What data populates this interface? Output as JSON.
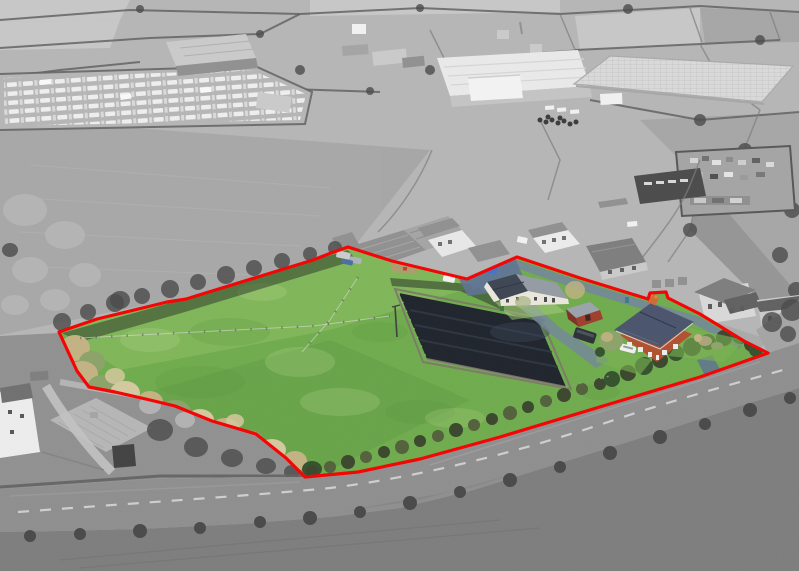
{
  "meta": {
    "title": "Aerial drone photograph of a smallholding for sale — plot outlined in red, property shown in colour against greyscale countryside",
    "width_px": 799,
    "height_px": 571,
    "style": "selective-colour aerial photograph"
  },
  "scene": {
    "highlighted_plot": [
      "large grass paddock with post-and-rail fencing",
      "mature winter trees along the south-west edge",
      "dark all-weather riding arena (menage)",
      "single-storey stable / annexe building with slate roof and white walls",
      "red timber shed with grey roof",
      "two-storey red-brick farmhouse with slate roof and chimney pots",
      "garden lawns, hedges and shrubs",
      "blue-grey tarmac driveways and parking",
      "white car, two blue cars, dark van, stored caravans",
      "telegraph pole in paddock"
    ],
    "greyscale_surroundings": [
      "patchwork farmland fields with hedgerows",
      "caravan storage yard full of white caravans",
      "large industrial warehouse unit",
      "glasshouse / polytunnel complex",
      "farm barns and concrete yards",
      "walled scrap and storage yard",
      "neighbouring houses and garages",
      "stone barn and white cottage beside the road",
      "country road with dashed centre line",
      "large field south of the road"
    ],
    "overlay": "continuous red boundary line enclosing the property"
  },
  "colors": {
    "boundary": "#f60000",
    "grass_light": "#93c468",
    "grass_mid": "#6fab4c",
    "grass_dark": "#55923a",
    "grass_pale": "#aacf7d",
    "hedge_dark": "#39462b",
    "hedge_mid": "#51603a",
    "bush_dark": "#33502c",
    "tree_tan": "#c3b382",
    "tree_tan_light": "#d4c89e",
    "tree_sage": "#8ba268",
    "arena": "#1d222b",
    "arena_streak": "#2f3844",
    "arena_edge": "#7b7567",
    "drive_blue": "#73849c",
    "drive_blue_dark": "#5d7292",
    "brick": "#b1502e",
    "brick_dark": "#7e3021",
    "roof_slate": "#49536b",
    "roof_ridge": "#5d6983",
    "chimney_pot": "#cf6a33",
    "shed_wall": "#9f3d2a",
    "shed_roof": "#9aa2ab",
    "bung_wall": "#ebe7dc",
    "bung_roof": "#3d4452",
    "bung_roof_hip": "#959ba3",
    "car_blue": "#2e62b8",
    "car_blue2": "#3f74cc",
    "car_white": "#f1f1f1",
    "van_dark": "#2a2f36",
    "bin_teal": "#3d7a8c",
    "bin_green": "#3f7a3f",
    "muck_tan": "#b09a6e",
    "g1": "#cacaca",
    "g2": "#b6b6b6",
    "g3": "#a4a4a4",
    "g4": "#909090",
    "g5": "#7d7d7d",
    "g6": "#606060",
    "g7": "#484848",
    "road": "#8e8e8e",
    "road_mark": "#d6d6d6",
    "wh_roof": "#eaeaea",
    "wh_face": "#c4c4c4",
    "gh_roof": "#dadada",
    "white": "#f2f2f2"
  }
}
